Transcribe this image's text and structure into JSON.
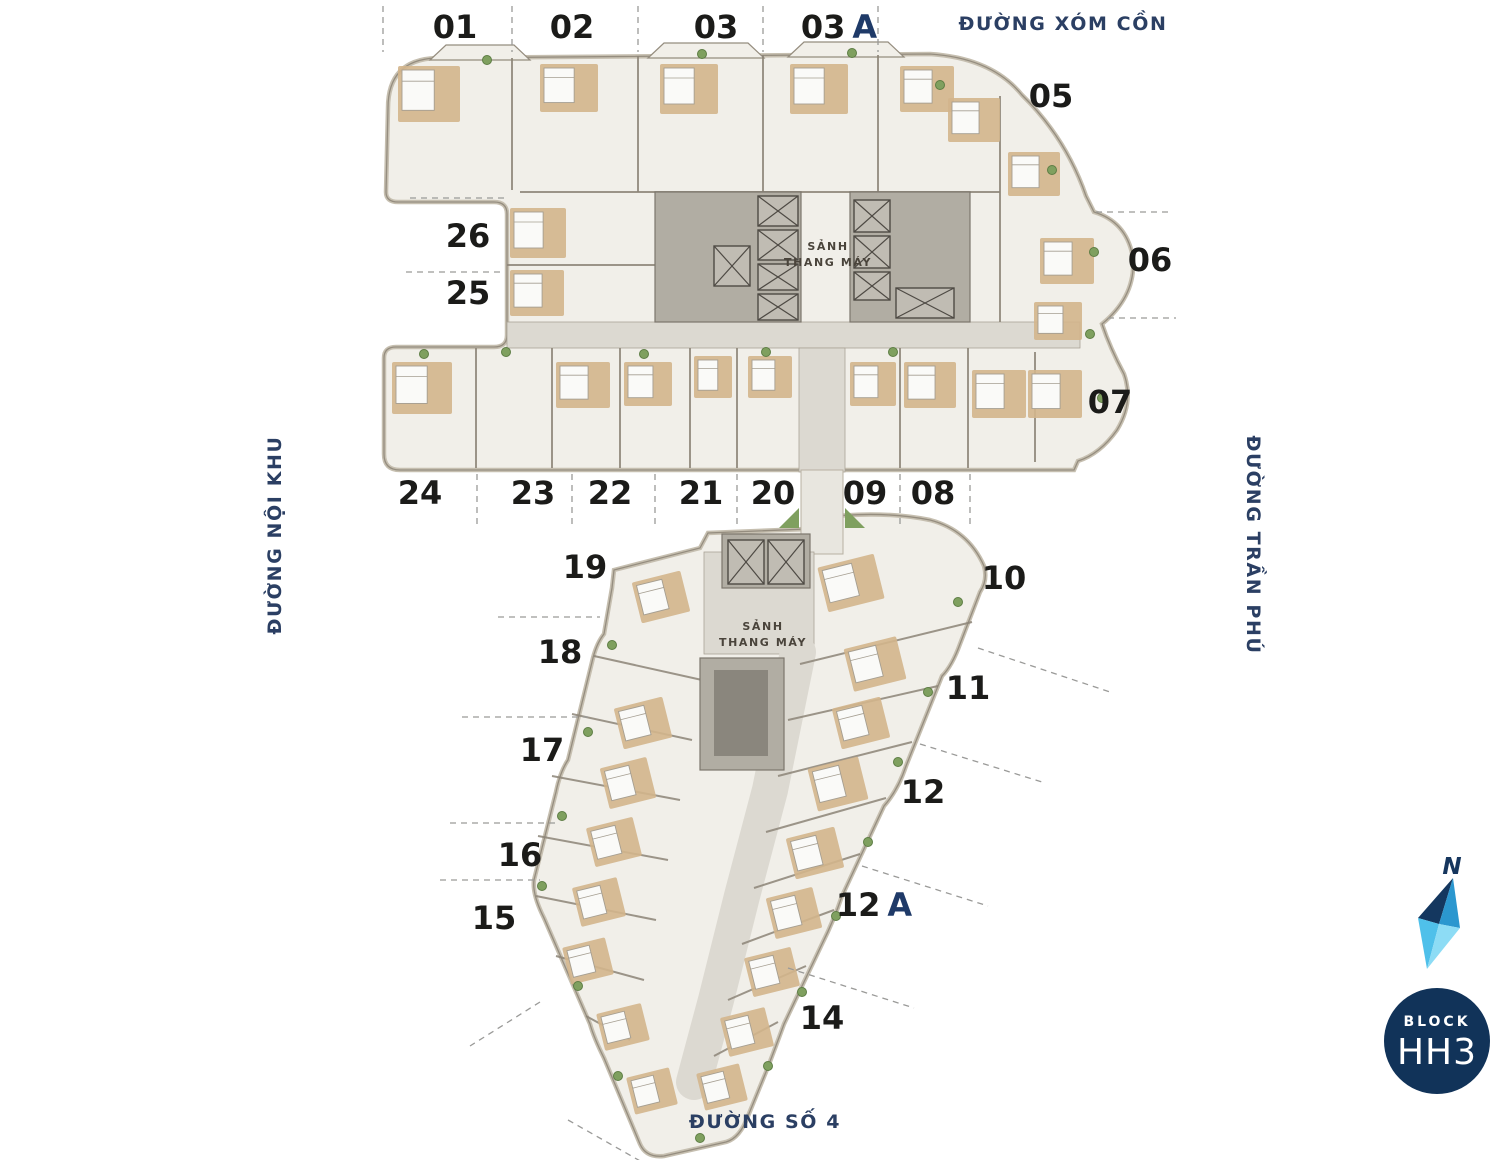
{
  "page": {
    "background": "#ffffff"
  },
  "colors": {
    "accent_navy": "#1f3a68",
    "street_text": "#2b3f63",
    "label_text": "#1b1b19",
    "badge_bg": "#113359",
    "badge_text": "#ffffff",
    "plan_fill": "#f1efe9",
    "plan_edge": "#c6bfb0",
    "wall": "#8d8578",
    "corridor": "#dcd9d1",
    "core": "#b1ada3",
    "lift_box": "#c0bcb3",
    "lift_stroke": "#4e4a44",
    "bedroom": "#d3b58c",
    "bed": "#fafaf8",
    "plant": "#7fa05f",
    "leader": "#9a9a98",
    "compass_dark": "#14375f",
    "compass_mid": "#2b97cf",
    "compass_light": "#4fc0ea",
    "compass_lighter": "#8ddcf5"
  },
  "units": [
    {
      "label": "01",
      "x": 455,
      "y": 27
    },
    {
      "label": "02",
      "x": 572,
      "y": 27
    },
    {
      "label": "03",
      "x": 716,
      "y": 27
    },
    {
      "label": "03",
      "suffix": "A",
      "x": 839,
      "y": 27
    },
    {
      "label": "05",
      "x": 1051,
      "y": 96
    },
    {
      "label": "06",
      "x": 1150,
      "y": 260
    },
    {
      "label": "07",
      "x": 1110,
      "y": 402
    },
    {
      "label": "26",
      "x": 468,
      "y": 236
    },
    {
      "label": "25",
      "x": 468,
      "y": 293
    },
    {
      "label": "24",
      "x": 420,
      "y": 493
    },
    {
      "label": "23",
      "x": 533,
      "y": 493
    },
    {
      "label": "22",
      "x": 610,
      "y": 493
    },
    {
      "label": "21",
      "x": 701,
      "y": 493
    },
    {
      "label": "20",
      "x": 773,
      "y": 493
    },
    {
      "label": "09",
      "x": 865,
      "y": 493
    },
    {
      "label": "08",
      "x": 933,
      "y": 493
    },
    {
      "label": "19",
      "x": 585,
      "y": 567
    },
    {
      "label": "18",
      "x": 560,
      "y": 652
    },
    {
      "label": "17",
      "x": 542,
      "y": 750
    },
    {
      "label": "16",
      "x": 520,
      "y": 855
    },
    {
      "label": "15",
      "x": 494,
      "y": 918
    },
    {
      "label": "10",
      "x": 1004,
      "y": 578
    },
    {
      "label": "11",
      "x": 968,
      "y": 688
    },
    {
      "label": "12",
      "x": 923,
      "y": 792
    },
    {
      "label": "12",
      "suffix": "A",
      "x": 874,
      "y": 905
    },
    {
      "label": "14",
      "x": 822,
      "y": 1018
    }
  ],
  "streets": [
    {
      "label": "ĐƯỜNG XÓM CỒN",
      "x": 1063,
      "y": 30,
      "rotate": 0
    },
    {
      "label": "ĐƯỜNG TRẦN PHÚ",
      "x": 1247,
      "y": 545,
      "rotate": 90
    },
    {
      "label": "ĐƯỜNG NỘI KHU",
      "x": 281,
      "y": 535,
      "rotate": -90
    },
    {
      "label": "ĐƯỜNG SỐ 4",
      "x": 765,
      "y": 1128,
      "rotate": 0
    }
  ],
  "lobbies": [
    {
      "line1": "SẢNH",
      "line2": "THANG MÁY"
    },
    {
      "line1": "SẢNH",
      "line2": "THANG MÁY"
    }
  ],
  "compass": {
    "letter": "N"
  },
  "badge": {
    "top": "BLOCK",
    "main": "HH3"
  }
}
